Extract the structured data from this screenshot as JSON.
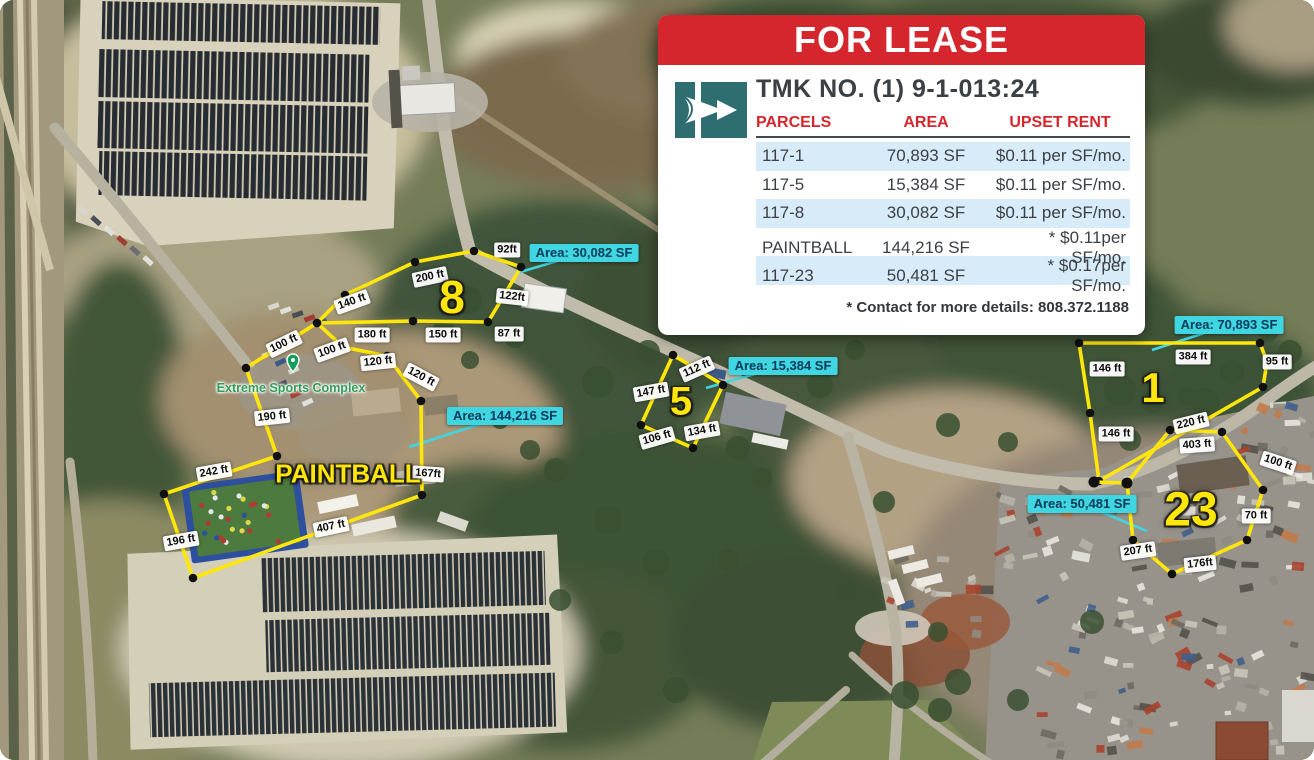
{
  "card": {
    "title": "FOR LEASE",
    "tmk": "TMK NO. (1) 9-1-013:24",
    "columns": [
      "PARCELS",
      "AREA",
      "UPSET RENT"
    ],
    "rows": [
      {
        "parcel": "117-1",
        "area": "70,893 SF",
        "rent": "$0.11 per SF/mo."
      },
      {
        "parcel": "117-5",
        "area": "15,384 SF",
        "rent": "$0.11 per SF/mo."
      },
      {
        "parcel": "117-8",
        "area": "30,082 SF",
        "rent": "$0.11 per SF/mo."
      },
      {
        "parcel": "PAINTBALL",
        "area": "144,216 SF",
        "rent": "* $0.11per SF/mo."
      },
      {
        "parcel": "117-23",
        "area": "50,481 SF",
        "rent": "* $0.17per SF/mo."
      }
    ],
    "footnote": "* Contact for more details: 808.372.1188",
    "logo": "teal-arrow-logo"
  },
  "map": {
    "place_label": "Extreme Sports Complex",
    "place_x": 291,
    "place_y": 388,
    "parcel_ids": [
      {
        "t": "8",
        "x": 452,
        "y": 297,
        "s": 46
      },
      {
        "t": "5",
        "x": 681,
        "y": 402,
        "s": 40
      },
      {
        "t": "1",
        "x": 1153,
        "y": 388,
        "s": 42
      },
      {
        "t": "23",
        "x": 1191,
        "y": 510,
        "s": 48
      },
      {
        "t": "PAINTBALL",
        "x": 348,
        "y": 474,
        "s": 26
      }
    ],
    "parcels": [
      {
        "id": "8",
        "closed": true,
        "points": "317,323 345,295 415,262 474,251 521,267 488,322 413,321"
      },
      {
        "id": "paintball",
        "closed": true,
        "points": "317,323 343,347 387,356 421,401 422,495 193,578 164,494 277,456 246,368"
      },
      {
        "id": "5",
        "closed": true,
        "points": "673,355 723,385 693,448 641,425"
      },
      {
        "id": "1",
        "closed": true,
        "points": "1079,343 1260,343 1267,362 1263,387 1099,481 1090,413"
      },
      {
        "id": "23",
        "closed": true,
        "points": "1127,483 1170,430 1222,432 1263,490 1247,540 1172,574 1133,540"
      },
      {
        "id": "junction-link",
        "closed": false,
        "dot": 5.5,
        "points": "1094,482 1127,483"
      }
    ],
    "measurements": [
      {
        "t": "92ft",
        "x": 507,
        "y": 250,
        "r": 0
      },
      {
        "t": "200 ft",
        "x": 430,
        "y": 277,
        "r": -12
      },
      {
        "t": "140 ft",
        "x": 352,
        "y": 302,
        "r": -20
      },
      {
        "t": "122ft",
        "x": 512,
        "y": 297,
        "r": 6
      },
      {
        "t": "180 ft",
        "x": 372,
        "y": 335,
        "r": 0
      },
      {
        "t": "150 ft",
        "x": 443,
        "y": 335,
        "r": 0
      },
      {
        "t": "87 ft",
        "x": 509,
        "y": 334,
        "r": 0
      },
      {
        "t": "100 ft",
        "x": 284,
        "y": 344,
        "r": -26
      },
      {
        "t": "100 ft",
        "x": 332,
        "y": 350,
        "r": -20
      },
      {
        "t": "120 ft",
        "x": 378,
        "y": 362,
        "r": -6
      },
      {
        "t": "120 ft",
        "x": 421,
        "y": 377,
        "r": 28
      },
      {
        "t": "190 ft",
        "x": 272,
        "y": 417,
        "r": -6
      },
      {
        "t": "242 ft",
        "x": 214,
        "y": 472,
        "r": -10
      },
      {
        "t": "196 ft",
        "x": 181,
        "y": 541,
        "r": -10
      },
      {
        "t": "407 ft",
        "x": 331,
        "y": 527,
        "r": -12
      },
      {
        "t": "167ft",
        "x": 428,
        "y": 474,
        "r": 4
      },
      {
        "t": "112 ft",
        "x": 697,
        "y": 369,
        "r": -24
      },
      {
        "t": "147 ft",
        "x": 651,
        "y": 392,
        "r": -10
      },
      {
        "t": "134 ft",
        "x": 702,
        "y": 431,
        "r": -10
      },
      {
        "t": "106 ft",
        "x": 657,
        "y": 438,
        "r": -16
      },
      {
        "t": "384 ft",
        "x": 1193,
        "y": 357,
        "r": 0
      },
      {
        "t": "95 ft",
        "x": 1277,
        "y": 362,
        "r": 0
      },
      {
        "t": "146 ft",
        "x": 1107,
        "y": 369,
        "r": 0
      },
      {
        "t": "146 ft",
        "x": 1116,
        "y": 434,
        "r": 0
      },
      {
        "t": "220 ft",
        "x": 1191,
        "y": 423,
        "r": -14
      },
      {
        "t": "403 ft",
        "x": 1197,
        "y": 445,
        "r": -4
      },
      {
        "t": "100 ft",
        "x": 1278,
        "y": 463,
        "r": 18
      },
      {
        "t": "70 ft",
        "x": 1256,
        "y": 516,
        "r": 0
      },
      {
        "t": "176ft",
        "x": 1200,
        "y": 564,
        "r": -6
      },
      {
        "t": "207 ft",
        "x": 1138,
        "y": 551,
        "r": -8
      }
    ],
    "area_labels": [
      {
        "text": "Area: 30,082 SF",
        "x": 584,
        "y": 253,
        "tx": 517,
        "ty": 273
      },
      {
        "text": "Area: 15,384 SF",
        "x": 783,
        "y": 366,
        "tx": 706,
        "ty": 388
      },
      {
        "text": "Area: 144,216 SF",
        "x": 505,
        "y": 416,
        "tx": 409,
        "ty": 447
      },
      {
        "text": "Area: 70,893 SF",
        "x": 1229,
        "y": 325,
        "tx": 1152,
        "ty": 350
      },
      {
        "text": "Area: 50,481 SF",
        "x": 1082,
        "y": 504,
        "tx": 1147,
        "ty": 531
      }
    ]
  },
  "colors": {
    "brand_red": "#d6262d",
    "logo_teal": "#2e6e70",
    "parcel_yellow": "#ffe60a",
    "area_cyan": "#3fd6e2",
    "area_text": "#0a3a58",
    "row_alt_blue": "#d7ebf8",
    "table_text": "#3c4146"
  }
}
